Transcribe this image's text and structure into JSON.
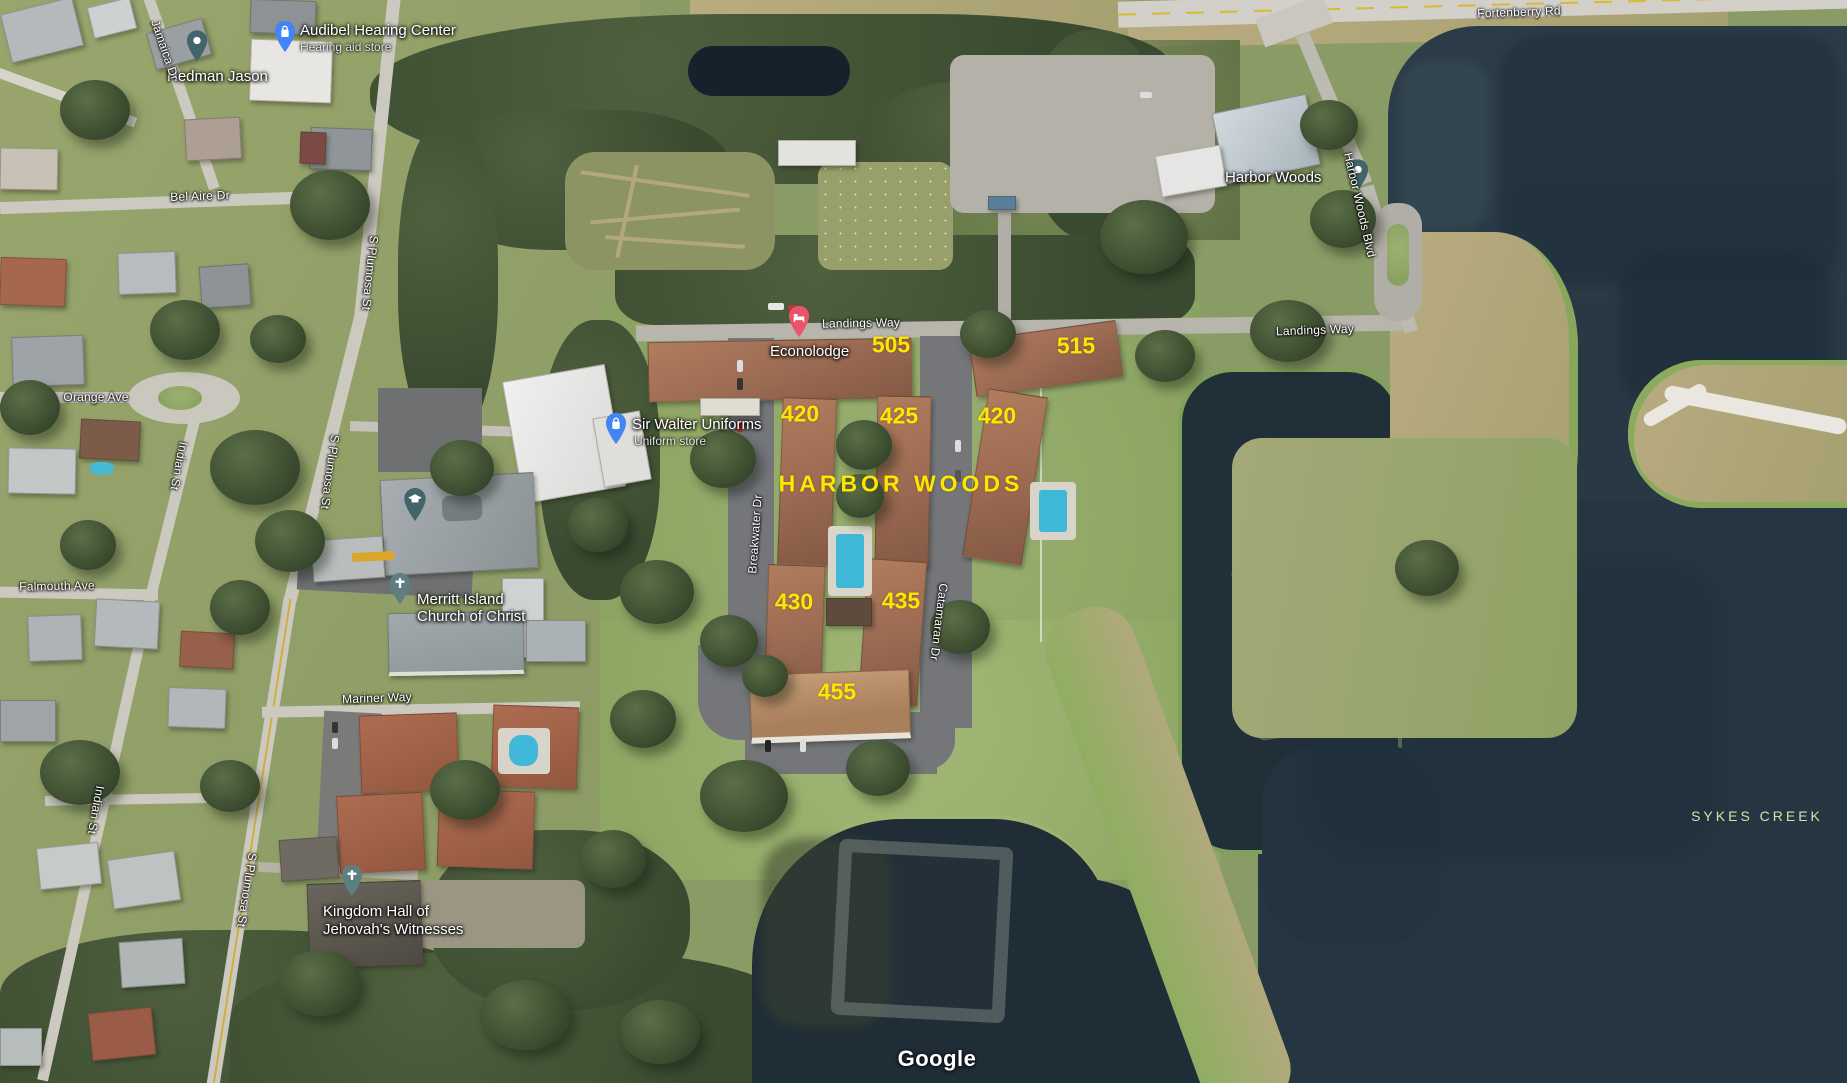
{
  "watermark": "Google",
  "water_label": "SYKES CREEK",
  "community": {
    "name": "HARBOR WOODS",
    "units": [
      "505",
      "515",
      "420",
      "425",
      "420",
      "430",
      "435",
      "455"
    ]
  },
  "roads": {
    "jamaica": "Jamaica Dr",
    "bel_aire": "Bel Aire Dr",
    "plumosa": "S Plumosa St",
    "orange": "Orange Ave",
    "indian": "Indian St",
    "falmouth": "Falmouth Ave",
    "mariner": "Mariner Way",
    "landings": "Landings Way",
    "breakwater": "Breakwater Dr",
    "catamaran": "Catamaran Dr",
    "harbor_woods_blvd": "Harbor Woods Blvd",
    "fortenberry": "Fortenberry Rd"
  },
  "places": {
    "audibel": {
      "title": "Audibel Hearing Center",
      "subtitle": "Hearing aid store"
    },
    "hedman": {
      "title": "Hedman Jason"
    },
    "sir_walter": {
      "title": "Sir Walter Uniforms",
      "subtitle": "Uniform store"
    },
    "econolodge": {
      "title": "Econolodge"
    },
    "harbor_woods_poi": {
      "title": "Harbor Woods"
    },
    "merritt_island_church": {
      "line1": "Merritt Island",
      "line2": "Church of Christ"
    },
    "kingdom_hall": {
      "line1": "Kingdom Hall of",
      "line2": "Jehovah's Witnesses"
    }
  },
  "colors": {
    "unit_overlay": "#ffe600",
    "water_label_green": "#cde4a9",
    "store_pin": "#4285f4",
    "lodging_pin": "#e9536b",
    "poi_pin": "#44646b",
    "church_pin": "#5e7f81"
  }
}
